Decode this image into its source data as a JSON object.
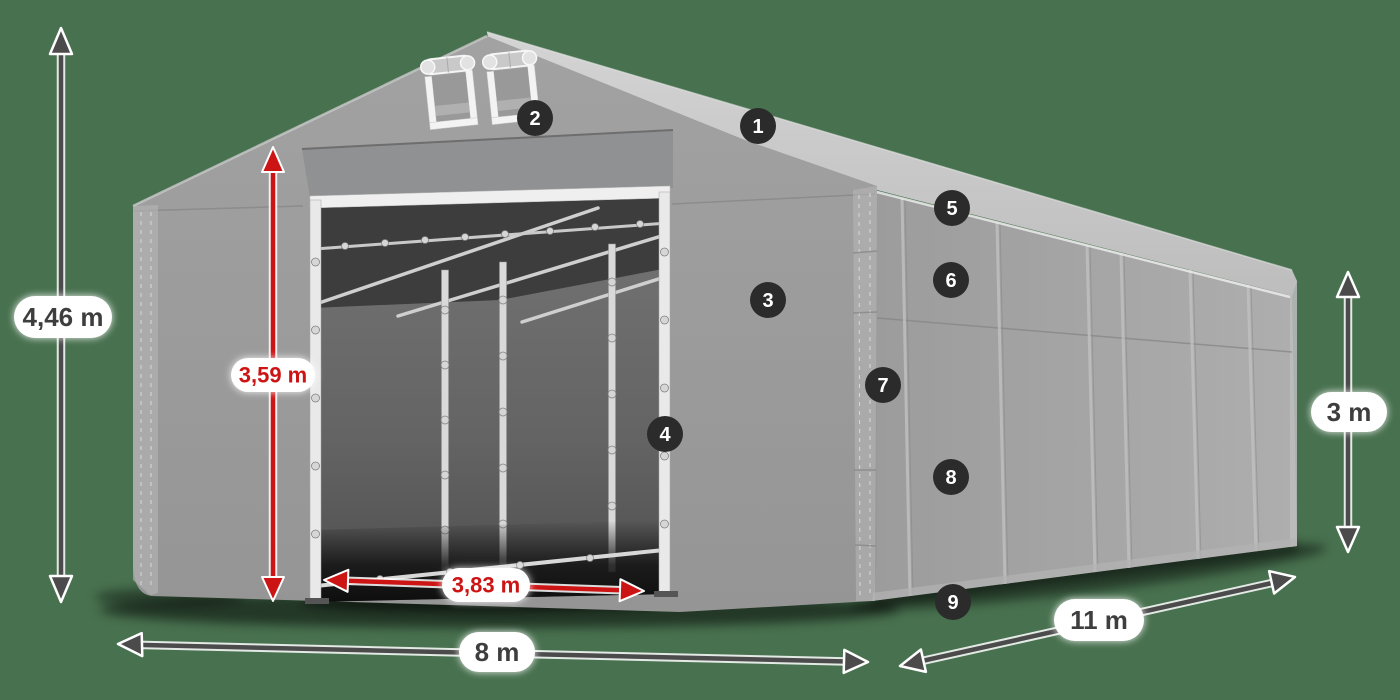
{
  "diagram": {
    "dimensions": {
      "total_height": {
        "text": "4,46 m",
        "color": "dark"
      },
      "door_height": {
        "text": "3,59 m",
        "color": "red"
      },
      "door_width": {
        "text": "3,83 m",
        "color": "red"
      },
      "front_width": {
        "text": "8 m",
        "color": "dark"
      },
      "side_length": {
        "text": "11 m",
        "color": "dark"
      },
      "side_height": {
        "text": "3 m",
        "color": "dark"
      }
    },
    "markers": {
      "m1": "1",
      "m2": "2",
      "m3": "3",
      "m4": "4",
      "m5": "5",
      "m6": "6",
      "m7": "7",
      "m8": "8",
      "m9": "9"
    }
  },
  "colors": {
    "background": "#48714F",
    "accent_red": "#cc1414",
    "arrow_dark": "#4b4b4b",
    "marker_badge": "#2b2b2b",
    "label_text": "#3e3e3e",
    "label_pill": "#ffffff"
  }
}
